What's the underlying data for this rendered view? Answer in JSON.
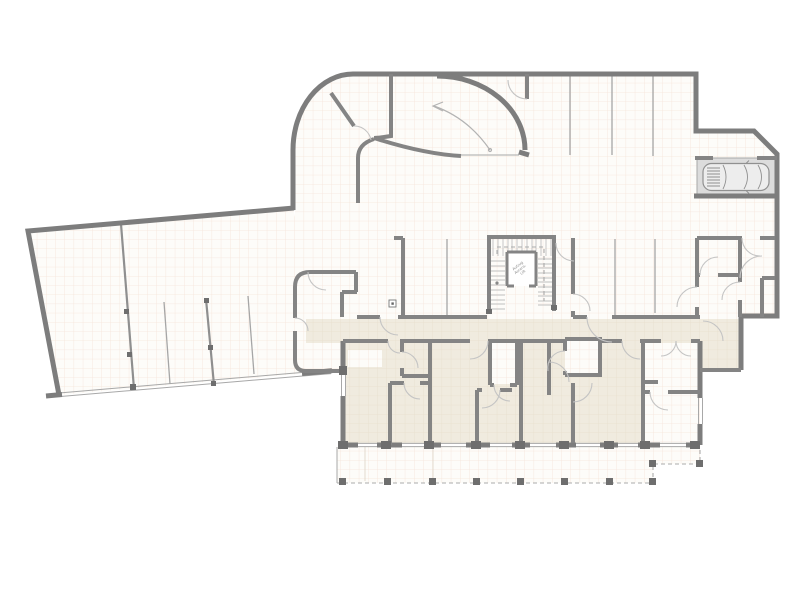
{
  "plan": {
    "elevator_label_lines": [
      "Aufzug",
      "Ascens.",
      "Lift"
    ]
  },
  "palette": {
    "background": "#ffffff",
    "wall": "#7d7d7d",
    "wall_inner": "#848484",
    "divider": "#a6a6a6",
    "door_arc": "#c4c4c4",
    "dashed": "#ababab",
    "tread": "#c0c0c0",
    "grid_line": "#f5e4da",
    "grid_line_beige": "#e8dfcd",
    "floor_white": "#fdfcf9",
    "floor_beige": "#f0ebdf",
    "parking_spot": "#dcdcdc",
    "column": "#6e6e6e",
    "window_line": "#a8a8a8",
    "car_body": "#ededed",
    "car_line": "#909090",
    "arrow": "#b3b3b3"
  }
}
